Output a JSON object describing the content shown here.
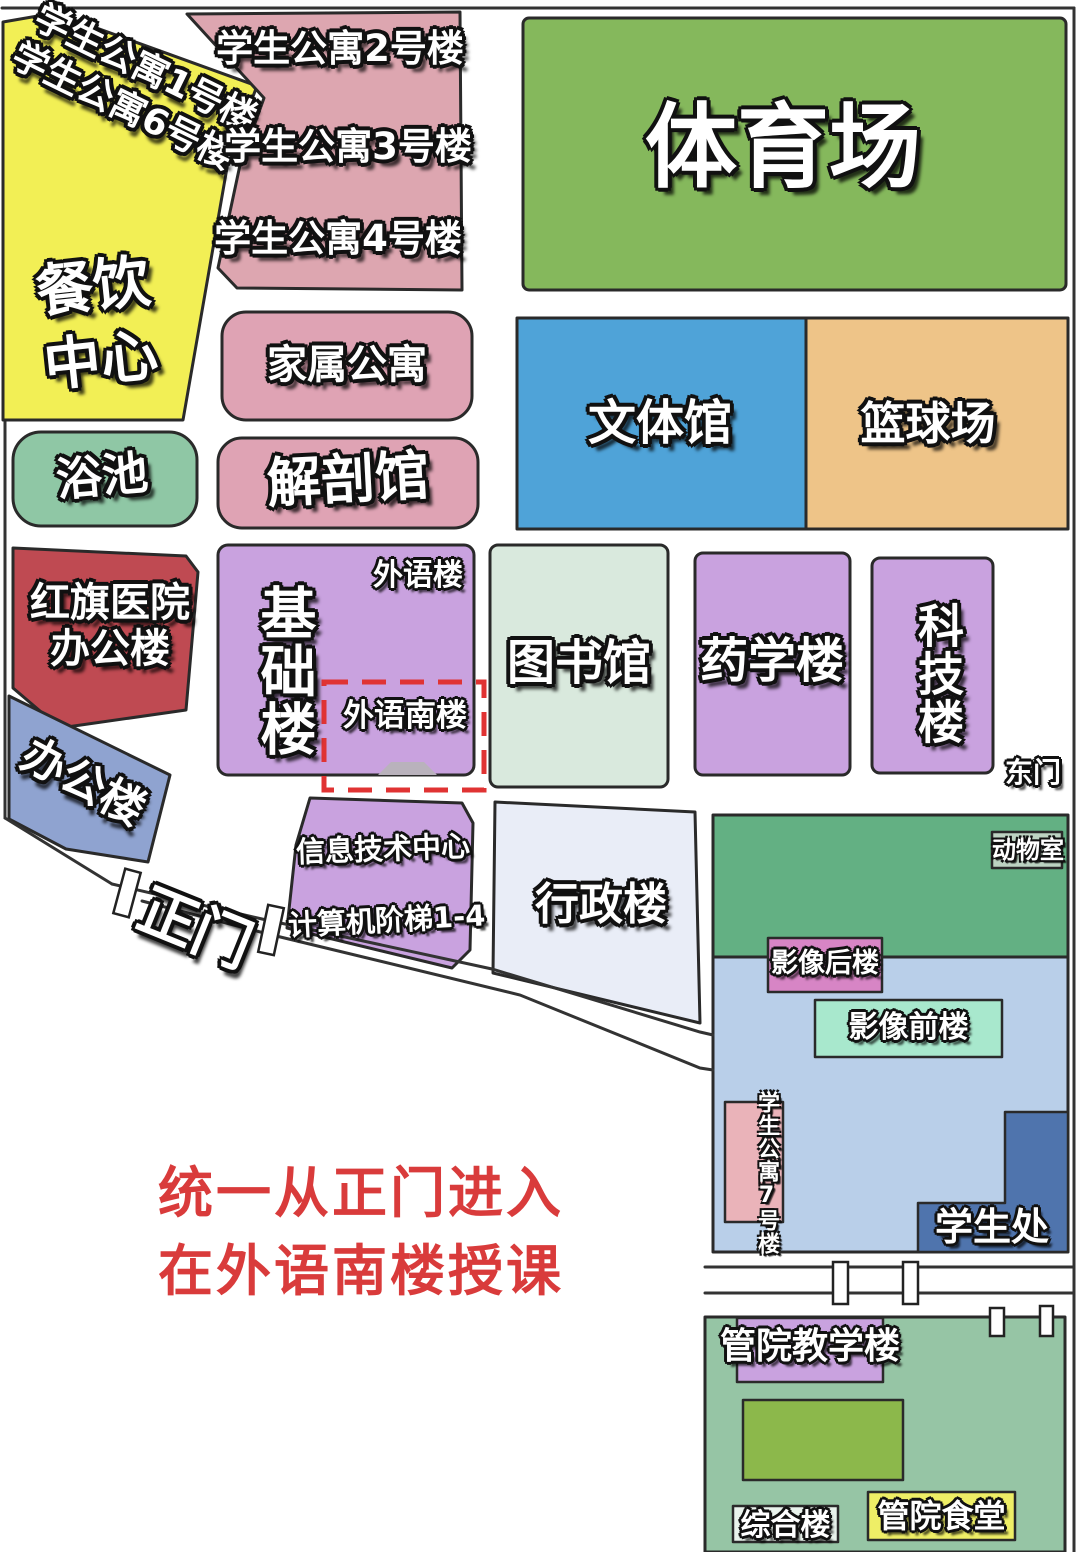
{
  "colors": {
    "background": "#ffffff",
    "outline": "#2a2a2a",
    "yellow": "#f2ef55",
    "dorm_pink": "#dda6b0",
    "room_pink": "#dfa3b4",
    "bath_green": "#8fc7a5",
    "stadium_green": "#85b85c",
    "gym_blue": "#4fa3d8",
    "basketball_orange": "#eec488",
    "hospital_red": "#bf4a52",
    "office_blue": "#8fa3d0",
    "purple": "#c9a2df",
    "library_mint": "#d9e9dd",
    "admin_pale": "#e9edf7",
    "complex_green": "#63b083",
    "complex_blue": "#b9cfe9",
    "animal_box": "#bdd3c2",
    "imaging_rear_pink": "#d785c5",
    "imaging_front_mint": "#a8e8cd",
    "dorm7_pink": "#eab3b9",
    "student_blue": "#4f74ad",
    "mgmt_green": "#96c5a5",
    "mgmt_inner_green": "#8cb84b",
    "composite_box": "#e9f3ec",
    "canteen_yellow": "#eeee66",
    "door_gray": "#b9b2bc",
    "dashed_red": "#e03333",
    "note_red": "#d93b3b"
  },
  "labels": {
    "dorm1": "学生公寓1号楼",
    "dorm6": "学生公寓6号楼",
    "dorm2": "学生公寓2号楼",
    "dorm3": "学生公寓3号楼",
    "dorm4": "学生公寓4号楼",
    "canteen_l1": "餐饮",
    "canteen_l2": "中心",
    "bath": "浴池",
    "family_apartment": "家属公寓",
    "anatomy": "解剖馆",
    "stadium": "体育场",
    "gym": "文体馆",
    "basketball": "篮球场",
    "hospital_l1": "红旗医院",
    "hospital_l2": "办公楼",
    "office": "办公楼",
    "foundation": "基础楼",
    "foreign": "外语楼",
    "foreign_south": "外语南楼",
    "library": "图书馆",
    "pharmacy": "药学楼",
    "scitech": "科技楼",
    "east_gate": "东门",
    "it_center": "信息技术中心",
    "computer_rooms": "计算机阶梯1-4",
    "admin": "行政楼",
    "main_gate": "正门",
    "animal_room": "动物室",
    "imaging_rear": "影像后楼",
    "imaging_front": "影像前楼",
    "dorm7": "学生公寓7号楼",
    "student_affairs": "学生处",
    "mgmt_teaching": "管院教学楼",
    "composite": "综合楼",
    "mgmt_canteen": "管院食堂"
  },
  "note": {
    "line1": "统一从正门进入",
    "line2": "在外语南楼授课"
  }
}
